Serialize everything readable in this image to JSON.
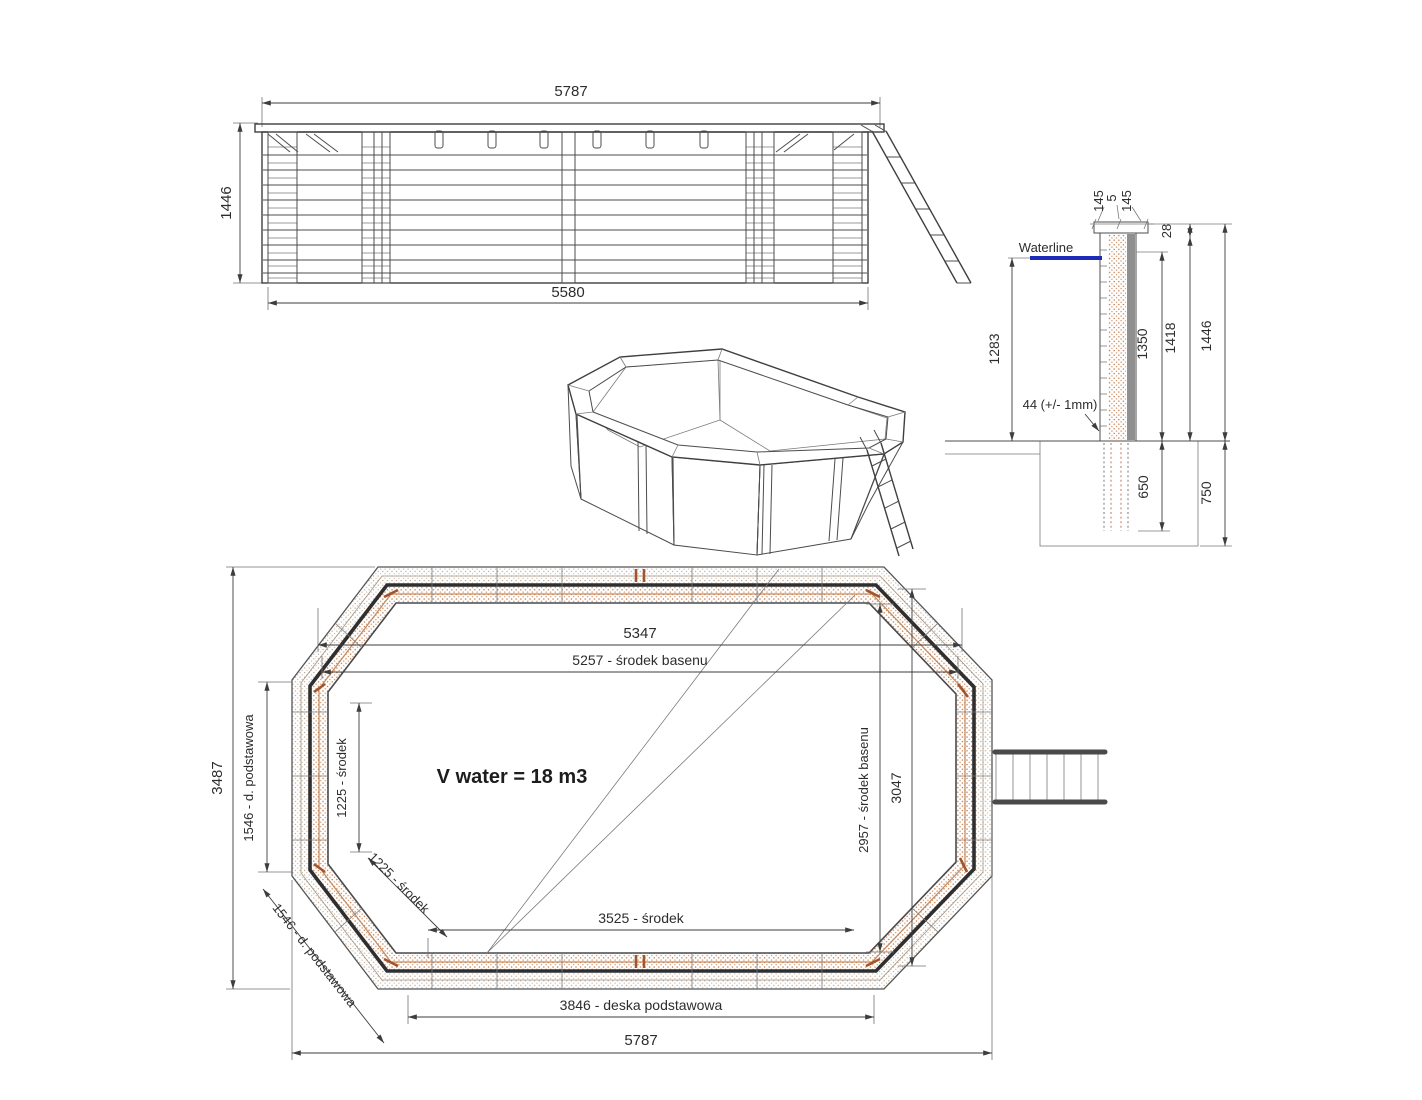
{
  "title": "Wooden octagonal pool technical drawing",
  "colors": {
    "background": "#ffffff",
    "line": "#3d3d3d",
    "waterline": "#1e2bb8",
    "hatch_orange": "#bf7a4e",
    "hatch_light": "#b5a18f",
    "accent_joint": "#a2552a"
  },
  "elevation": {
    "dim_top": "5787",
    "dim_bottom": "5580",
    "dim_left": "1446"
  },
  "section": {
    "cap_left": "145",
    "cap_gap": "5",
    "cap_right": "145",
    "dim_28": "28",
    "waterline_label": "Waterline",
    "dim_1283": "1283",
    "dim_1350": "1350",
    "dim_1418": "1418",
    "dim_1446": "1446",
    "note_44": "44 (+/- 1mm)",
    "dim_650": "650",
    "dim_750": "750"
  },
  "plan": {
    "dim_5347": "5347",
    "dim_5257": "5257 - środek basenu",
    "dim_3487": "3487",
    "dim_1546_left": "1546 - d. podstawowa",
    "dim_1225_left": "1225 - środek",
    "dim_1225_diag": "1225 - środek",
    "dim_1546_diag": "1546 - d. podstawowa",
    "volume": "V water = 18 m3",
    "dim_2957": "2957 - środek basenu",
    "dim_3047": "3047",
    "dim_3525": "3525 - środek",
    "dim_3846": "3846 - deska podstawowa",
    "dim_5787": "5787"
  }
}
